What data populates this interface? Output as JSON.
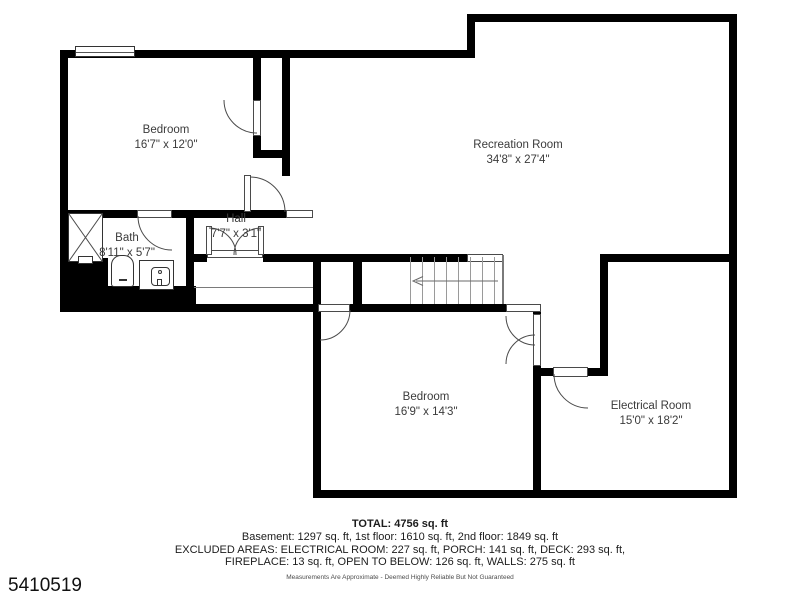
{
  "plan_id": "5410519",
  "rooms": [
    {
      "name": "Bedroom",
      "dims": "16'7\" x 12'0\""
    },
    {
      "name": "Recreation Room",
      "dims": "34'8\" x 27'4\""
    },
    {
      "name": "Bath",
      "dims": "8'11\" x 5'7\""
    },
    {
      "name": "Hall",
      "dims": "7'7\" x 3'1\""
    },
    {
      "name": "Bedroom",
      "dims": "16'9\" x 14'3\""
    },
    {
      "name": "Electrical Room",
      "dims": "15'0\" x 18'2\""
    }
  ],
  "footer": {
    "total": "TOTAL: 4756 sq. ft",
    "floors": "Basement: 1297 sq. ft, 1st floor: 1610 sq. ft, 2nd floor: 1849 sq. ft",
    "excluded_line1": "EXCLUDED AREAS: ELECTRICAL ROOM: 227 sq. ft, PORCH: 141 sq. ft, DECK: 293 sq. ft,",
    "excluded_line2": "FIREPLACE: 13 sq. ft, OPEN TO BELOW: 126 sq. ft, WALLS: 275 sq. ft",
    "disclaimer": "Measurements Are Approximate - Deemed Highly Reliable But Not Guaranteed"
  },
  "colors": {
    "wall": "#000000",
    "background": "#ffffff",
    "label_text": "#3b3b3b"
  }
}
